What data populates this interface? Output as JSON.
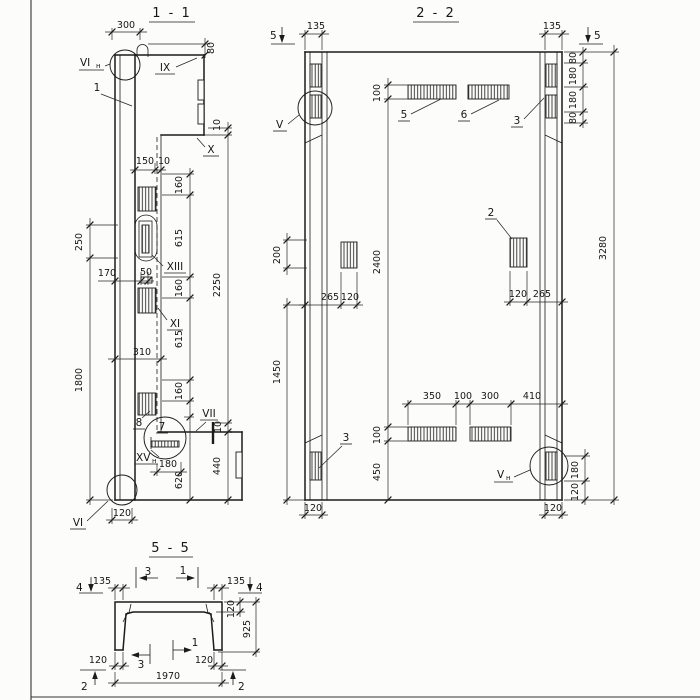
{
  "sheet": {
    "background": "#fcfcfa",
    "line_color": "#1b1b1b"
  },
  "s1": {
    "title": "1 - 1",
    "labels": {
      "mark_vi_top": {
        "base": "VI",
        "sub": "н"
      },
      "item1": "1",
      "mark_ix": "IX",
      "mark_x": "X",
      "mark_xiii": "XIII",
      "mark_xi": "XI",
      "item8": "8",
      "item7": "7",
      "mark_vii": "VII",
      "mark_xv": {
        "base": "XV",
        "sub": "н"
      },
      "mark_vi_bottom": "VI"
    },
    "dims": {
      "d300": "300",
      "d80": "80",
      "d10_top": "10",
      "d150": "150",
      "d10_mid": "10",
      "d160_1": "160",
      "d615_1": "615",
      "d160_2": "160",
      "d615_2": "615",
      "d160_3": "160",
      "d250": "250",
      "d1800": "1800",
      "d170": "170",
      "d50": "50",
      "d310": "310",
      "d2250": "2250",
      "d10_vii": "10",
      "d180": "180",
      "d620": "620",
      "d440": "440",
      "d120": "120"
    }
  },
  "s2": {
    "title": "2 - 2",
    "labels": {
      "cut5_left": "5",
      "cut5_right": "5",
      "mark_v": "V",
      "mark_v_n": {
        "base": "V",
        "sub": "н"
      },
      "item2": "2",
      "item3_top": "3",
      "item3_bottom": "3",
      "item5": "5",
      "item6": "6"
    },
    "dims": {
      "d135_l": "135",
      "d135_r": "135",
      "d80_1": "80",
      "d180_1": "180",
      "d180_2": "180",
      "d80_2": "80",
      "d3280": "3280",
      "d100_top": "100",
      "d2400": "2400",
      "d100_bot": "100",
      "d450": "450",
      "d200": "200",
      "d1450": "1450",
      "d265_l": "265",
      "d120_l": "120",
      "d120_r": "120",
      "d265_r": "265",
      "d350": "350",
      "d100_h": "100",
      "d300": "300",
      "d410": "410",
      "d180_br": "180",
      "d120_br": "120",
      "d120_col_l": "120",
      "d120_col_r": "120"
    }
  },
  "s5": {
    "title": "5 - 5",
    "labels": {
      "cut4_l": "4",
      "cut4_r": "4",
      "cut3_top": "3",
      "cut1_top": "1",
      "cut3_bot": "3",
      "cut1_bot": "1",
      "cut2_l": "2",
      "cut2_r": "2"
    },
    "dims": {
      "d135_l": "135",
      "d135_r": "135",
      "d120_slab": "120",
      "d925": "925",
      "d120_bl": "120",
      "d120_br": "120",
      "d1970": "1970"
    }
  }
}
